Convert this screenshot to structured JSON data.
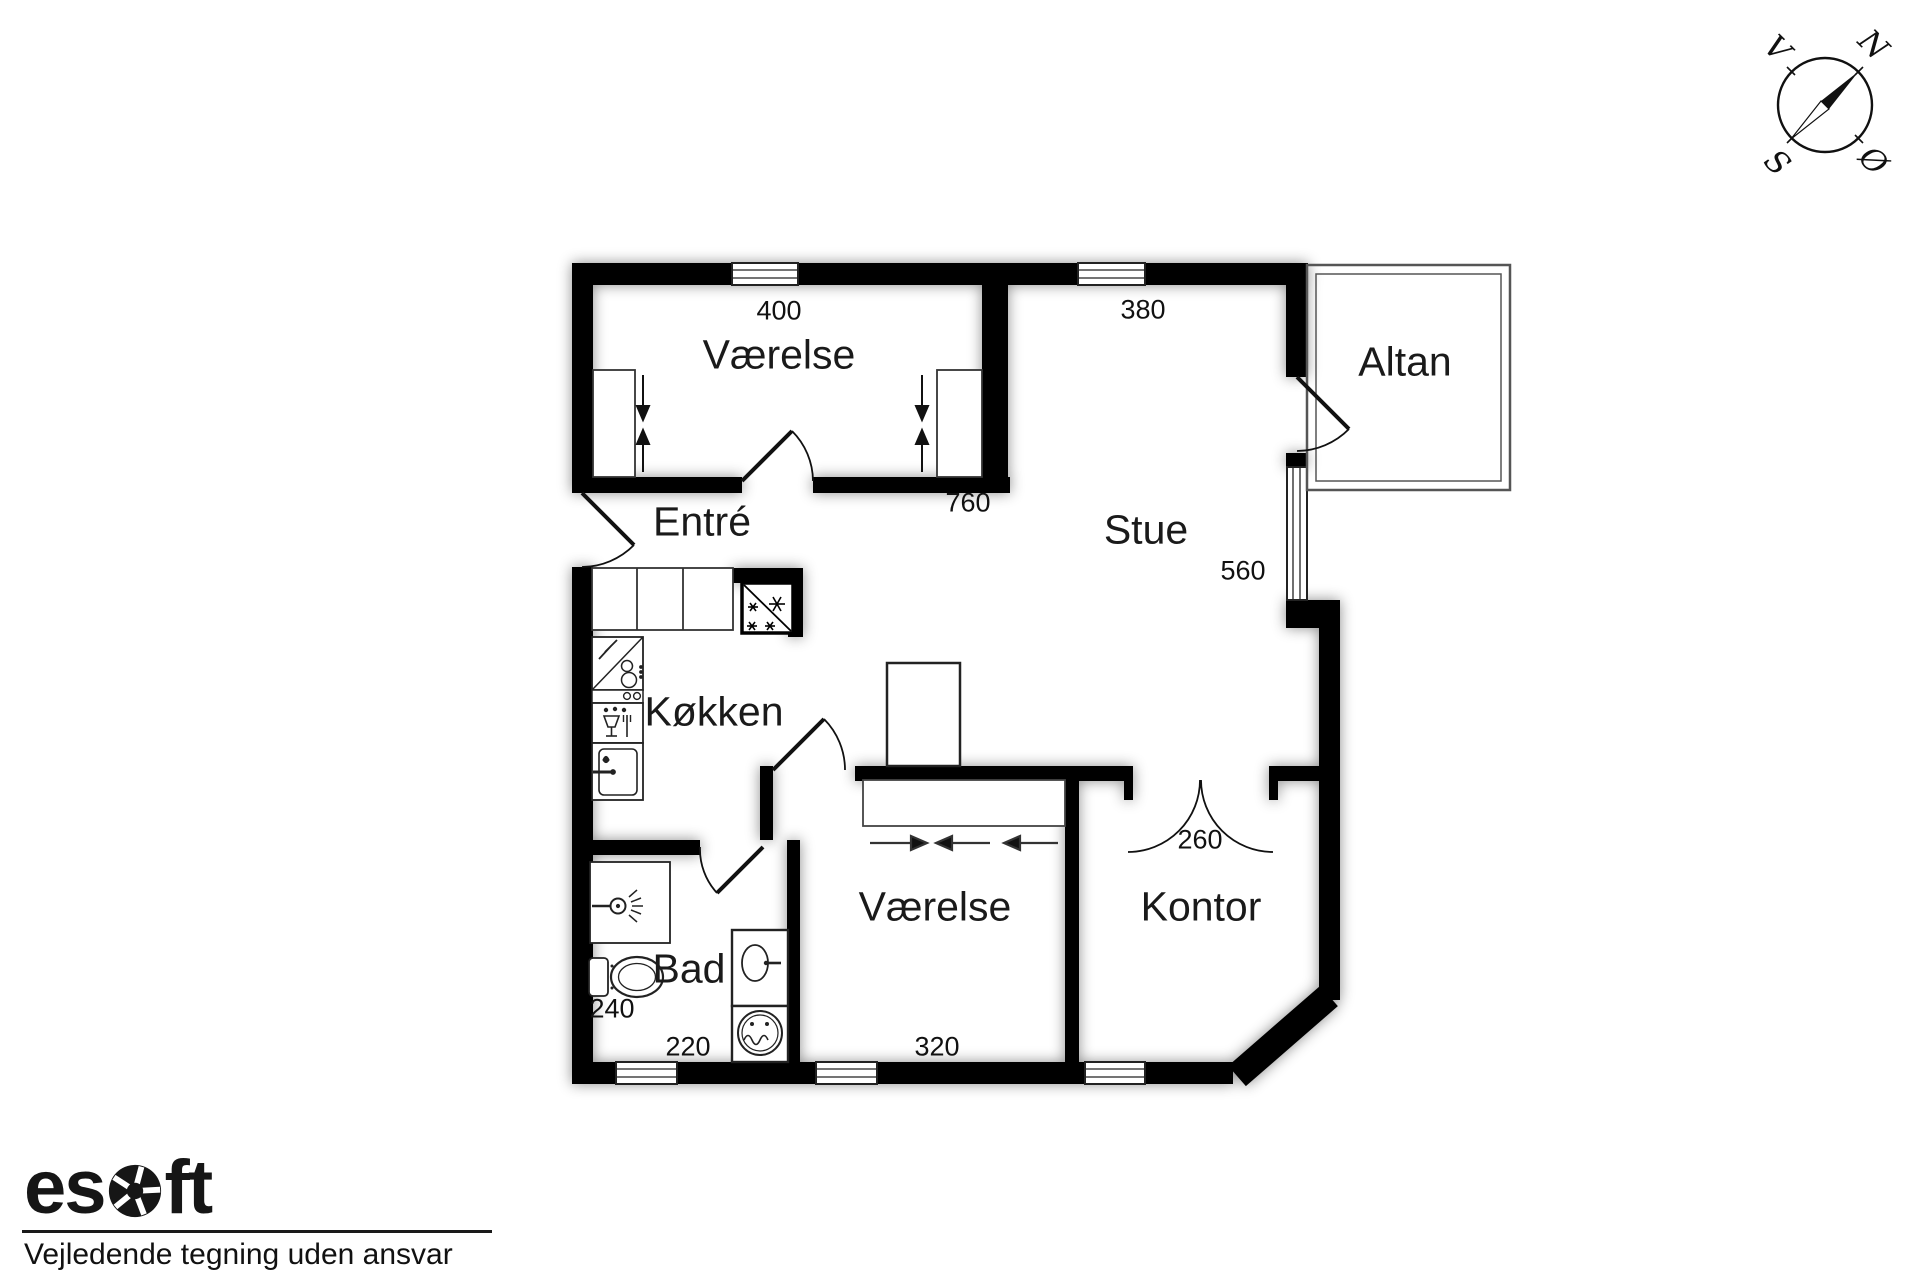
{
  "plan": {
    "rooms": {
      "vaerelse_top": "Værelse",
      "stue": "Stue",
      "altan": "Altan",
      "entre": "Entré",
      "koekken": "Køkken",
      "vaerelse_bottom": "Værelse",
      "kontor": "Kontor",
      "bad": "Bad"
    },
    "dimensions": {
      "vaerelse_top_width": "400",
      "stue_width": "380",
      "vaerelse_top_length": "760",
      "stue_depth": "560",
      "kontor_width": "260",
      "bad_width": "240",
      "bad_length": "220",
      "vaerelse_bottom_width": "320"
    }
  },
  "compass": {
    "north": "N",
    "west": "V",
    "south": "S",
    "east": "Ø"
  },
  "footer": {
    "logo_prefix": "es",
    "logo_suffix": "ft",
    "disclaimer": "Vejledende tegning uden ansvar"
  },
  "colors": {
    "ink": "#1a1a1a",
    "wall": "#000000",
    "background": "#ffffff"
  }
}
